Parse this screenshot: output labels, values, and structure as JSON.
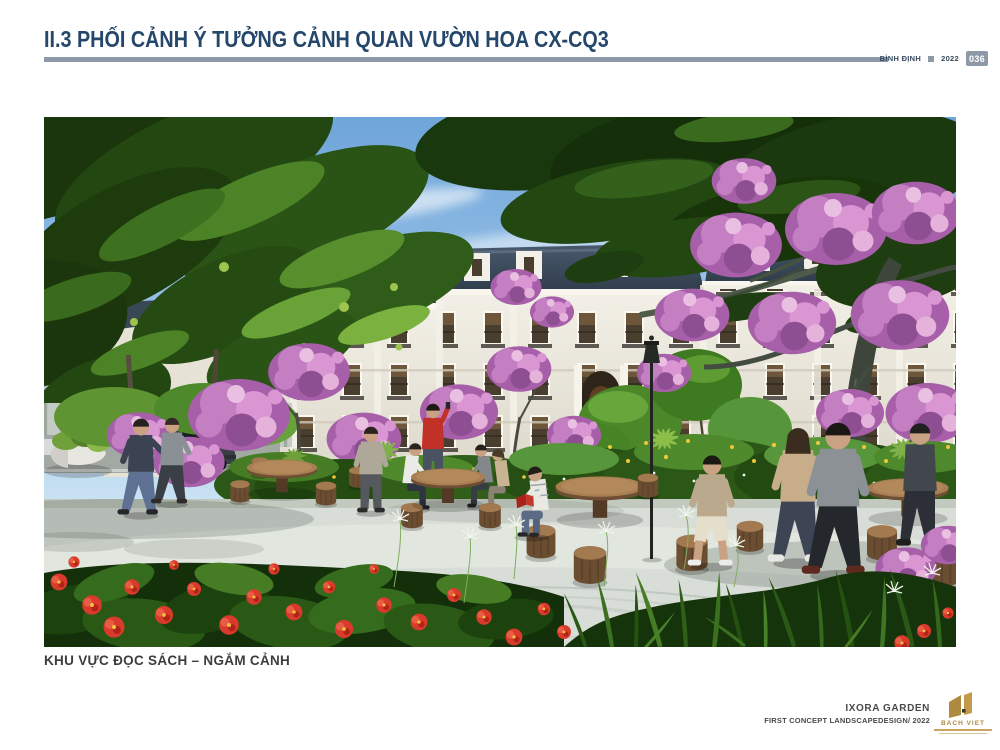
{
  "header": {
    "title": "II.3 PHỐI CẢNH Ý TƯỞNG CẢNH QUAN VƯỜN HOA CX-CQ3",
    "province": "BÌNH ĐỊNH",
    "year": "2022",
    "page_number": "036"
  },
  "figure": {
    "caption": "KHU VỰC ĐỌC SÁCH – NGẮM CẢNH"
  },
  "footer": {
    "project": "IXORA GARDEN",
    "subtitle": "FIRST CONCEPT LANDSCAPEDESIGN/ 2022",
    "logo_text": "BACH VIET"
  },
  "colors": {
    "title_navy": "#24476B",
    "rule_gray": "#8E99A7",
    "caption_gray": "#3D3D3D",
    "logo_gold": "#B08A3E"
  }
}
